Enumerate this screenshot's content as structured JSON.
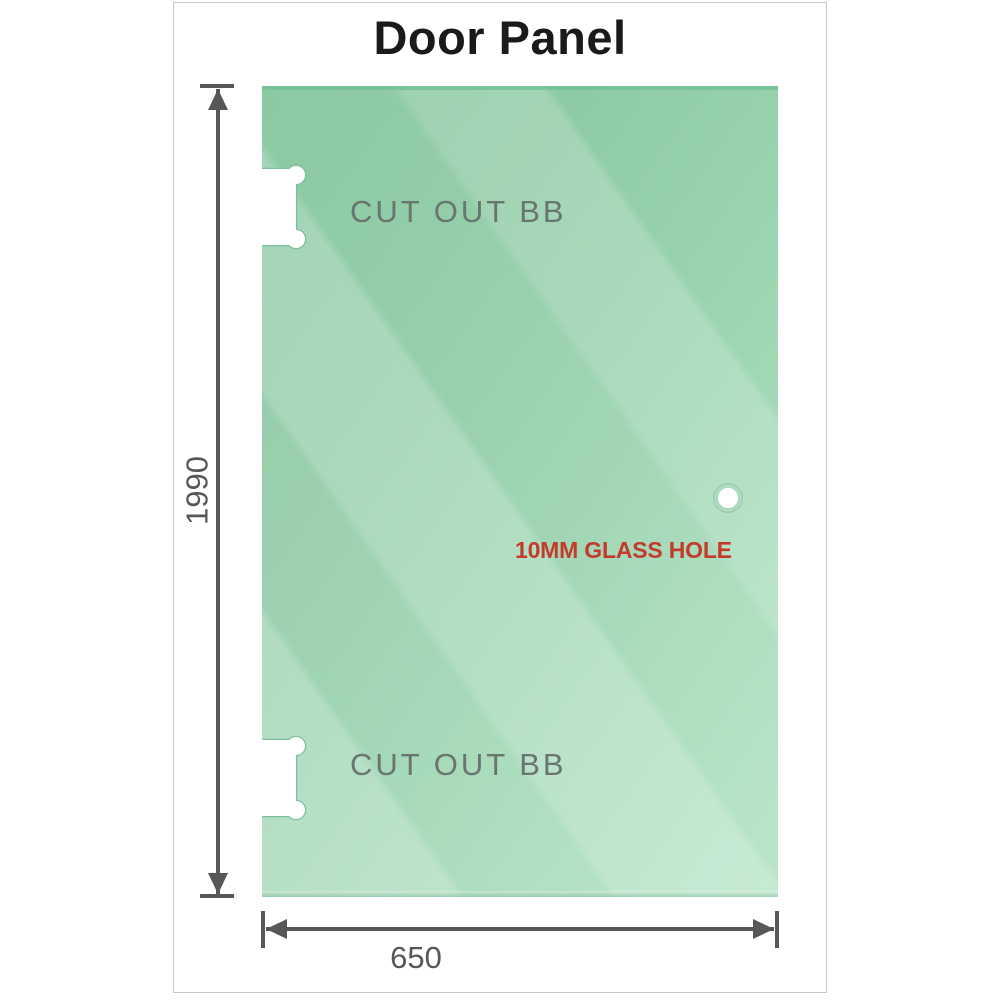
{
  "title": "Door Panel",
  "panel": {
    "cutout_top_label": "CUT OUT BB",
    "cutout_bottom_label": "CUT OUT BB",
    "glass_hole_label": "10MM GLASS HOLE"
  },
  "dimensions": {
    "height": {
      "label": "1990",
      "arrow": "double-headed-vertical-arrow"
    },
    "width": {
      "label": "650",
      "arrow": "double-headed-horizontal-arrow"
    }
  },
  "icons": {
    "top_notch": "hinge-cutout-notch",
    "bottom_notch": "hinge-cutout-notch",
    "hole": "glass-hole-circle"
  },
  "colors": {
    "title_text": "#1a1a1a",
    "frame_border": "#c8c8c8",
    "glass_dark": "#80c59a",
    "glass_mid": "#98d3ae",
    "glass_light": "#b5e3c5",
    "glass_edge": "#74c194",
    "notch_outline": "#7cc09b",
    "hole_ring": "#aed9c1",
    "hole_text": "#c43b2c",
    "cutout_text": "#687570",
    "dimension": "#575757"
  }
}
